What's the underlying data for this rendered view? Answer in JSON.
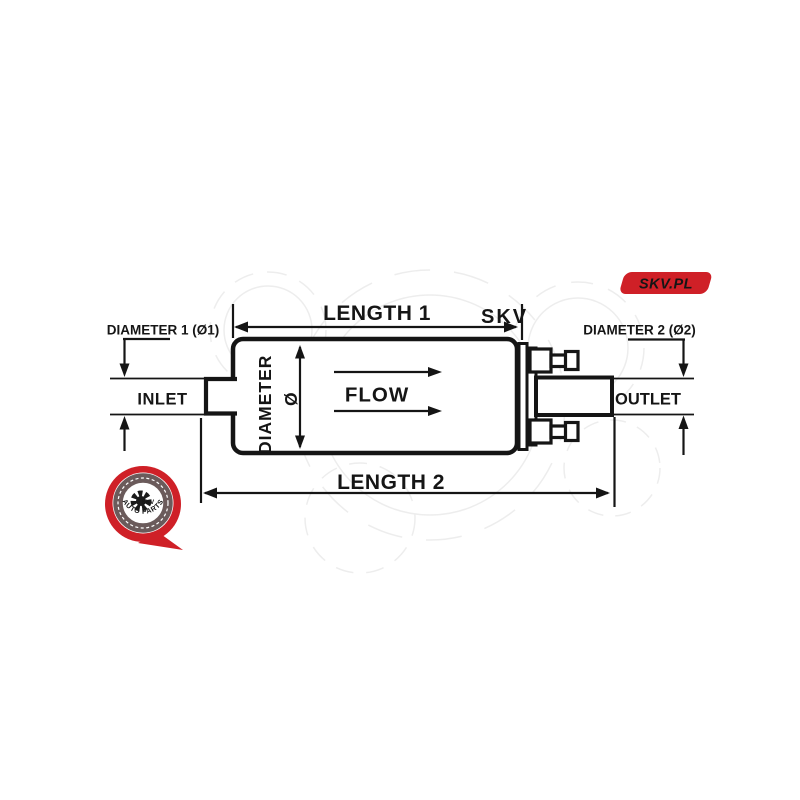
{
  "brand": {
    "badge_label": "SKV.PL",
    "badge_color": "#cf2027",
    "badge_text_color": "#ffffff",
    "logo": {
      "center_text": "SKV",
      "arc_text": "AUTO PARTS",
      "pin_color": "#cf2027",
      "ring_color": "#6b5b5b"
    }
  },
  "diagram": {
    "labels": {
      "length1": "LENGTH 1",
      "length2": "LENGTH 2",
      "diameter1": "DIAMETER 1 (Ø1)",
      "diameter2": "DIAMETER 2 (Ø2)",
      "diameter": "DIAMETER",
      "phi": "Ø",
      "flow": "FLOW",
      "inlet": "INLET",
      "outlet": "OUTLET"
    },
    "line_color": "#151515",
    "watermark": {
      "text": "SKV",
      "color": "#ededed"
    }
  }
}
